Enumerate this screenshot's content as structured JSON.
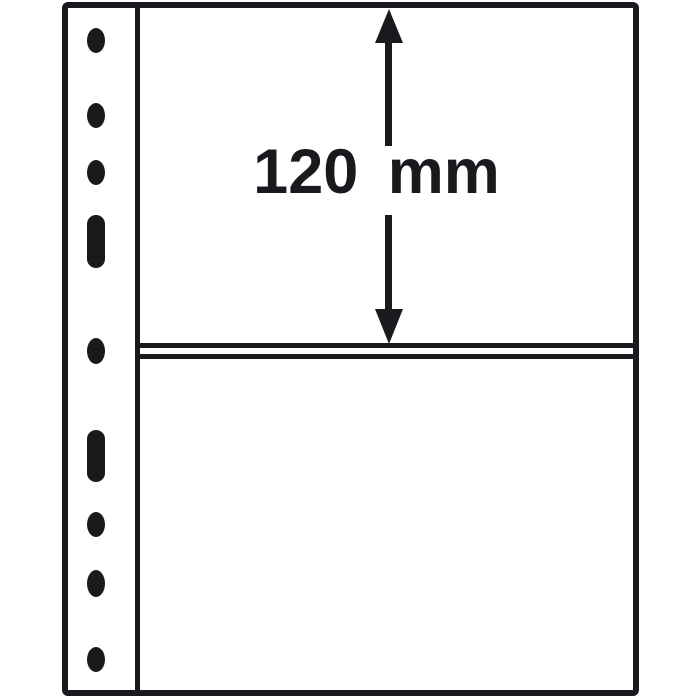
{
  "diagram": {
    "description": "Line diagram of a ring-binder album pocket page with two pockets",
    "dimension": {
      "label": "120 mm",
      "value": "120",
      "unit": "mm"
    },
    "pocket_count": 2,
    "punch_hole_count": 9,
    "colors": {
      "ink": "#1b191d",
      "paper": "#ffffff"
    }
  }
}
